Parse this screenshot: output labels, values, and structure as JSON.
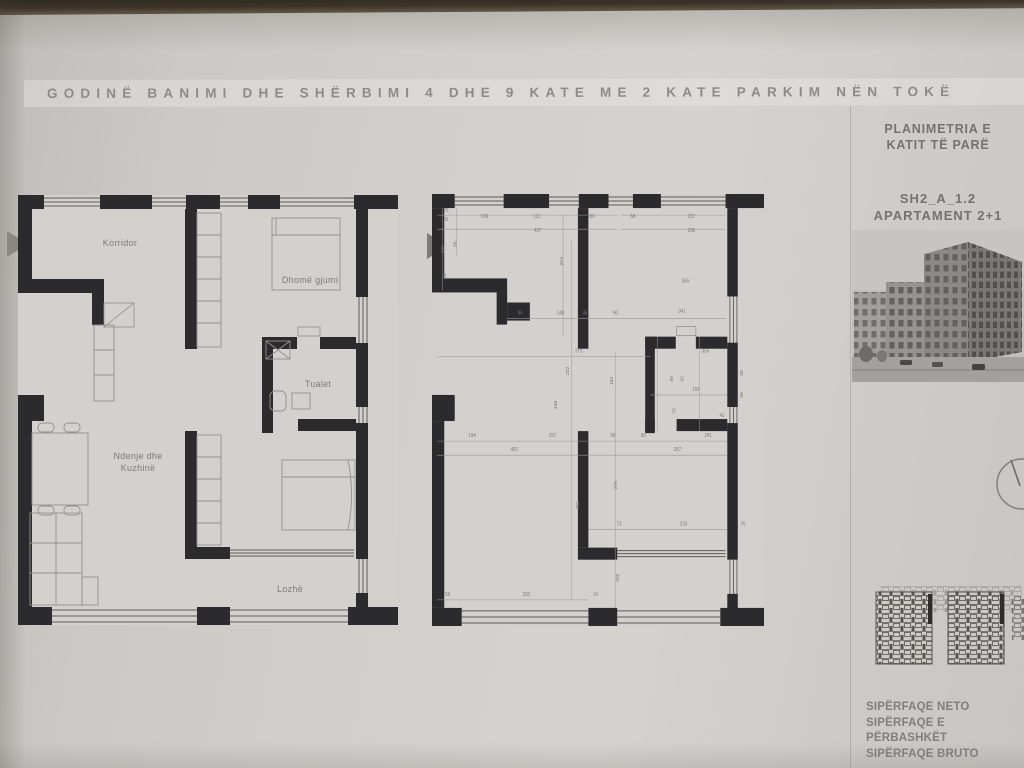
{
  "header": {
    "title": "GODINË BANIMI DHE SHËRBIMI 4 DHE 9 KATE ME 2 KATE PARKIM NËN TOKË"
  },
  "sidebar": {
    "plan_title_line1": "PLANIMETRIA E",
    "plan_title_line2": "KATIT TË PARË",
    "unit_code": "SH2_A_1.2",
    "apartment_type": "APARTAMENT 2+1",
    "areas": [
      "SIPËRFAQE NETO",
      "SIPËRFAQE E PËRBASHKËT",
      "SIPËRFAQE BRUTO"
    ]
  },
  "left_plan": {
    "rooms": {
      "korridor": "Korridor",
      "dhome_gjumi": "Dhomë gjumi",
      "tualet": "Tualet",
      "ndenje_line1": "Ndenje dhe",
      "ndenje_line2": "Kuzhinë",
      "lozhe": "Lozhë"
    }
  },
  "right_plan": {
    "dimensions": [
      {
        "t": "75",
        "x": 16,
        "y": 18
      },
      {
        "t": "43",
        "x": 16,
        "y": 27
      },
      {
        "t": "106",
        "x": 60,
        "y": 24
      },
      {
        "t": "111",
        "x": 120,
        "y": 24
      },
      {
        "t": "156",
        "x": 182,
        "y": 24
      },
      {
        "t": "68",
        "x": 230,
        "y": 24
      },
      {
        "t": "437",
        "x": 121,
        "y": 38
      },
      {
        "t": "237",
        "x": 297,
        "y": 24
      },
      {
        "t": "296",
        "x": 297,
        "y": 38
      },
      {
        "t": "100",
        "x": 14,
        "y": 55,
        "r": 1
      },
      {
        "t": "56",
        "x": 28,
        "y": 50,
        "r": 1
      },
      {
        "t": "36",
        "x": 16,
        "y": 82,
        "r": 1
      },
      {
        "t": "253",
        "x": 150,
        "y": 67,
        "r": 1
      },
      {
        "t": "365",
        "x": 290,
        "y": 88
      },
      {
        "t": "96",
        "x": 101,
        "y": 120
      },
      {
        "t": "148",
        "x": 147,
        "y": 120
      },
      {
        "t": "45",
        "x": 175,
        "y": 120
      },
      {
        "t": "90",
        "x": 210,
        "y": 120
      },
      {
        "t": "341",
        "x": 286,
        "y": 118
      },
      {
        "t": "58",
        "x": 356,
        "y": 178,
        "r": 1
      },
      {
        "t": "379",
        "x": 168,
        "y": 158
      },
      {
        "t": "222",
        "x": 157,
        "y": 176,
        "r": 1
      },
      {
        "t": "192",
        "x": 207,
        "y": 186,
        "r": 1
      },
      {
        "t": "458",
        "x": 143,
        "y": 210,
        "r": 1
      },
      {
        "t": "355",
        "x": 313,
        "y": 158
      },
      {
        "t": "90",
        "x": 276,
        "y": 184,
        "r": 1
      },
      {
        "t": "92",
        "x": 288,
        "y": 184,
        "r": 1
      },
      {
        "t": "160",
        "x": 302,
        "y": 196
      },
      {
        "t": "96",
        "x": 356,
        "y": 200,
        "r": 1
      },
      {
        "t": "70",
        "x": 279,
        "y": 216,
        "r": 1
      },
      {
        "t": "41",
        "x": 332,
        "y": 222
      },
      {
        "t": "194",
        "x": 46,
        "y": 242
      },
      {
        "t": "257",
        "x": 138,
        "y": 242
      },
      {
        "t": "96",
        "x": 207,
        "y": 242
      },
      {
        "t": "90",
        "x": 242,
        "y": 242
      },
      {
        "t": "241",
        "x": 316,
        "y": 242
      },
      {
        "t": "403",
        "x": 94,
        "y": 256
      },
      {
        "t": "257",
        "x": 281,
        "y": 256
      },
      {
        "t": "276",
        "x": 212,
        "y": 290,
        "r": 1
      },
      {
        "t": "451",
        "x": 168,
        "y": 310,
        "r": 1
      },
      {
        "t": "73",
        "x": 214,
        "y": 330
      },
      {
        "t": "233",
        "x": 288,
        "y": 330
      },
      {
        "t": "76",
        "x": 356,
        "y": 330
      },
      {
        "t": "56",
        "x": 18,
        "y": 400
      },
      {
        "t": "233",
        "x": 108,
        "y": 400
      },
      {
        "t": "14",
        "x": 187,
        "y": 400
      },
      {
        "t": "202",
        "x": 214,
        "y": 382,
        "r": 1
      }
    ]
  },
  "colors": {
    "paper": "#d2d0cc",
    "wall_ink": "#2b2b2d",
    "label_ink": "#7d7b76",
    "top_edge": "#33291c"
  }
}
